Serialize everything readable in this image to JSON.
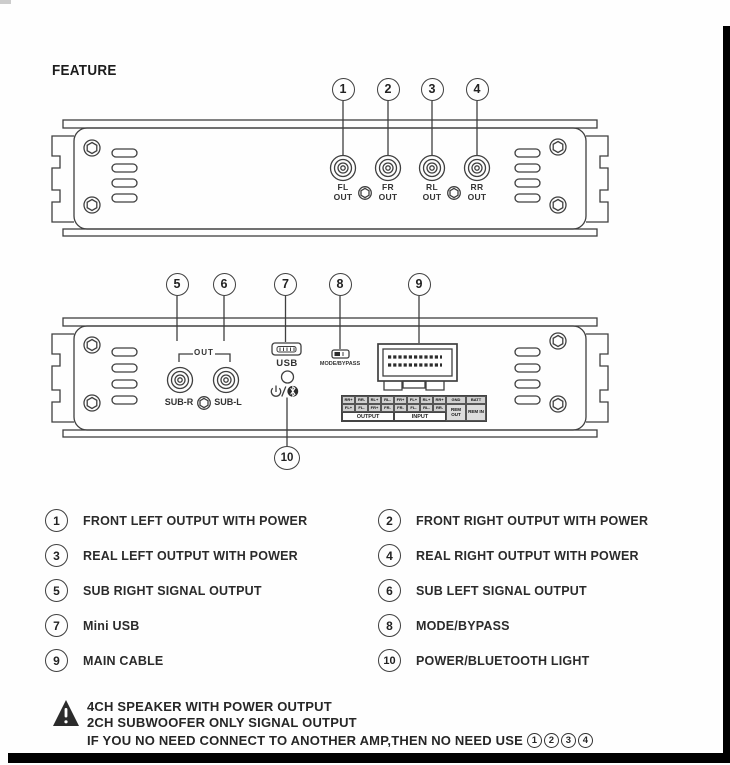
{
  "title": "FEATURE",
  "panel_top": {
    "callouts": [
      {
        "num": "1"
      },
      {
        "num": "2"
      },
      {
        "num": "3"
      },
      {
        "num": "4"
      }
    ],
    "jacks": [
      {
        "l1": "FL",
        "l2": "OUT"
      },
      {
        "l1": "FR",
        "l2": "OUT"
      },
      {
        "l1": "RL",
        "l2": "OUT"
      },
      {
        "l1": "RR",
        "l2": "OUT"
      }
    ]
  },
  "panel_bottom": {
    "callouts": [
      {
        "num": "5"
      },
      {
        "num": "6"
      },
      {
        "num": "7"
      },
      {
        "num": "8"
      },
      {
        "num": "9"
      }
    ],
    "callout_bottom": {
      "num": "10"
    },
    "out_bracket_label": "OUT",
    "sub_right_label": "SUB-R",
    "sub_left_label": "SUB-L",
    "usb_label": "USB",
    "mode_bypass_label": "MODE/BYPASS",
    "terminal_strip": {
      "row_top": [
        "RR+",
        "RR-",
        "RL+",
        "RL-",
        "FR+",
        "FL+",
        "RL+",
        "RR+",
        "GND",
        "BATT"
      ],
      "row_bottom": [
        "FL+",
        "FL-",
        "FR+",
        "FR-",
        "FR-",
        "FL-",
        "RL-",
        "RR-"
      ],
      "rem_out": "REM OUT",
      "rem_in": "REM IN",
      "output_label": "OUTPUT",
      "input_label": "INPUT"
    }
  },
  "legend": {
    "items": [
      {
        "num": "1",
        "label": "FRONT LEFT OUTPUT WITH POWER"
      },
      {
        "num": "2",
        "label": "FRONT RIGHT OUTPUT WITH POWER"
      },
      {
        "num": "3",
        "label": "REAL LEFT OUTPUT WITH POWER"
      },
      {
        "num": "4",
        "label": "REAL RIGHT OUTPUT WITH POWER"
      },
      {
        "num": "5",
        "label": "SUB RIGHT SIGNAL OUTPUT"
      },
      {
        "num": "6",
        "label": "SUB LEFT SIGNAL OUTPUT"
      },
      {
        "num": "7",
        "label": "Mini USB"
      },
      {
        "num": "8",
        "label": "MODE/BYPASS"
      },
      {
        "num": "9",
        "label": "MAIN CABLE"
      },
      {
        "num": "10",
        "label": "POWER/BLUETOOTH LIGHT"
      }
    ]
  },
  "warning": {
    "line1": "4CH SPEAKER WITH POWER OUTPUT",
    "line2": "2CH SUBWOOFER ONLY SIGNAL OUTPUT",
    "line3": "IF YOU NO NEED CONNECT TO ANOTHER AMP,THEN NO NEED USE",
    "refs": [
      "1",
      "2",
      "3",
      "4"
    ]
  },
  "colors": {
    "line": "#3f3f3f",
    "text": "#222222",
    "bar": "#000000",
    "page": "#fefefe"
  }
}
